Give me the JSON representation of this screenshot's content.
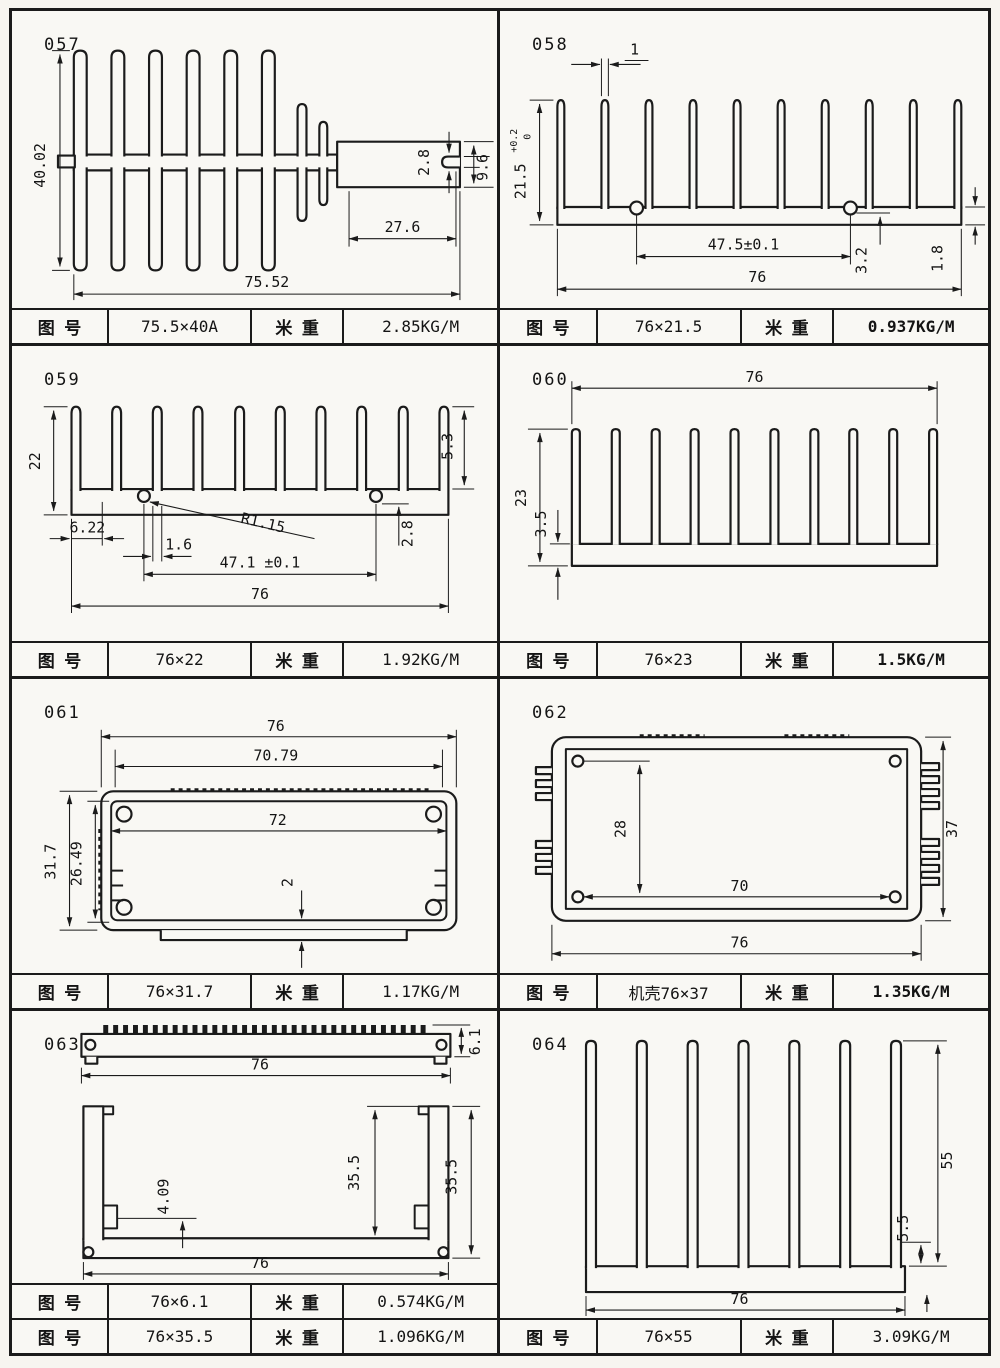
{
  "page": {
    "bg": "#f7f5f0",
    "line_color": "#1b1b1b"
  },
  "cells": [
    {
      "id": "057",
      "dims": {
        "overall_h": "40.02",
        "slot": "2.8",
        "end_h": "9.6",
        "bar_len": "27.6",
        "overall_w": "75.52"
      },
      "rows": [
        {
          "c1": "图  号",
          "c2": "75.5×40A",
          "c3": "米  重",
          "c4": "2.85KG/M"
        }
      ]
    },
    {
      "id": "058",
      "dims": {
        "fin_w": "1",
        "h": "21.5",
        "h_tol_up": "+0.2",
        "h_tol_dn": "0",
        "pitch": "47.5±0.1",
        "boss": "3.2",
        "base_t": "1.8",
        "w": "76"
      },
      "rows": [
        {
          "c1": "图  号",
          "c2": "76×21.5",
          "c3": "米  重",
          "c4": "0.937KG/M"
        }
      ]
    },
    {
      "id": "059",
      "dims": {
        "h": "22",
        "fin_h": "5.3",
        "edge_off": "6.22",
        "fin_w": "1.6",
        "radius": "R1.15",
        "base_t": "2.8",
        "pitch": "47.1 ±0.1",
        "w": "76"
      },
      "rows": [
        {
          "c1": "图  号",
          "c2": "76×22",
          "c3": "米  重",
          "c4": "1.92KG/M"
        }
      ]
    },
    {
      "id": "060",
      "dims": {
        "w": "76",
        "h": "23",
        "base_t": "3.5"
      },
      "rows": [
        {
          "c1": "图  号",
          "c2": "76×23",
          "c3": "米  重",
          "c4": "1.5KG/M"
        }
      ]
    },
    {
      "id": "061",
      "dims": {
        "w": "76",
        "top_inner": "70.79",
        "inner_w": "72",
        "h": "31.7",
        "inner_h": "26.49",
        "wall_t": "2"
      },
      "rows": [
        {
          "c1": "图  号",
          "c2": "76×31.7",
          "c3": "米  重",
          "c4": "1.17KG/M"
        }
      ]
    },
    {
      "id": "062",
      "dims": {
        "inner_h": "28",
        "inner_w": "70",
        "w": "76",
        "h": "37"
      },
      "rows": [
        {
          "c1": "图  号",
          "c2": "机壳76×37",
          "c3": "米  重",
          "c4": "1.35KG/M"
        }
      ]
    },
    {
      "id": "063",
      "dims": {
        "bar_w": "76",
        "bar_h": "6.1",
        "inner_h": "35.5",
        "outer_h": "35.5",
        "boss": "4.09",
        "w": "76"
      },
      "rows": [
        {
          "c1": "图  号",
          "c2": "76×6.1",
          "c3": "米  重",
          "c4": "0.574KG/M"
        },
        {
          "c1": "图  号",
          "c2": "76×35.5",
          "c3": "米  重",
          "c4": "1.096KG/M"
        }
      ]
    },
    {
      "id": "064",
      "dims": {
        "fin_h": "55",
        "base_t": "5.5",
        "w": "76"
      },
      "rows": [
        {
          "c1": "图  号",
          "c2": "76×55",
          "c3": "米  重",
          "c4": "3.09KG/M"
        }
      ]
    }
  ]
}
